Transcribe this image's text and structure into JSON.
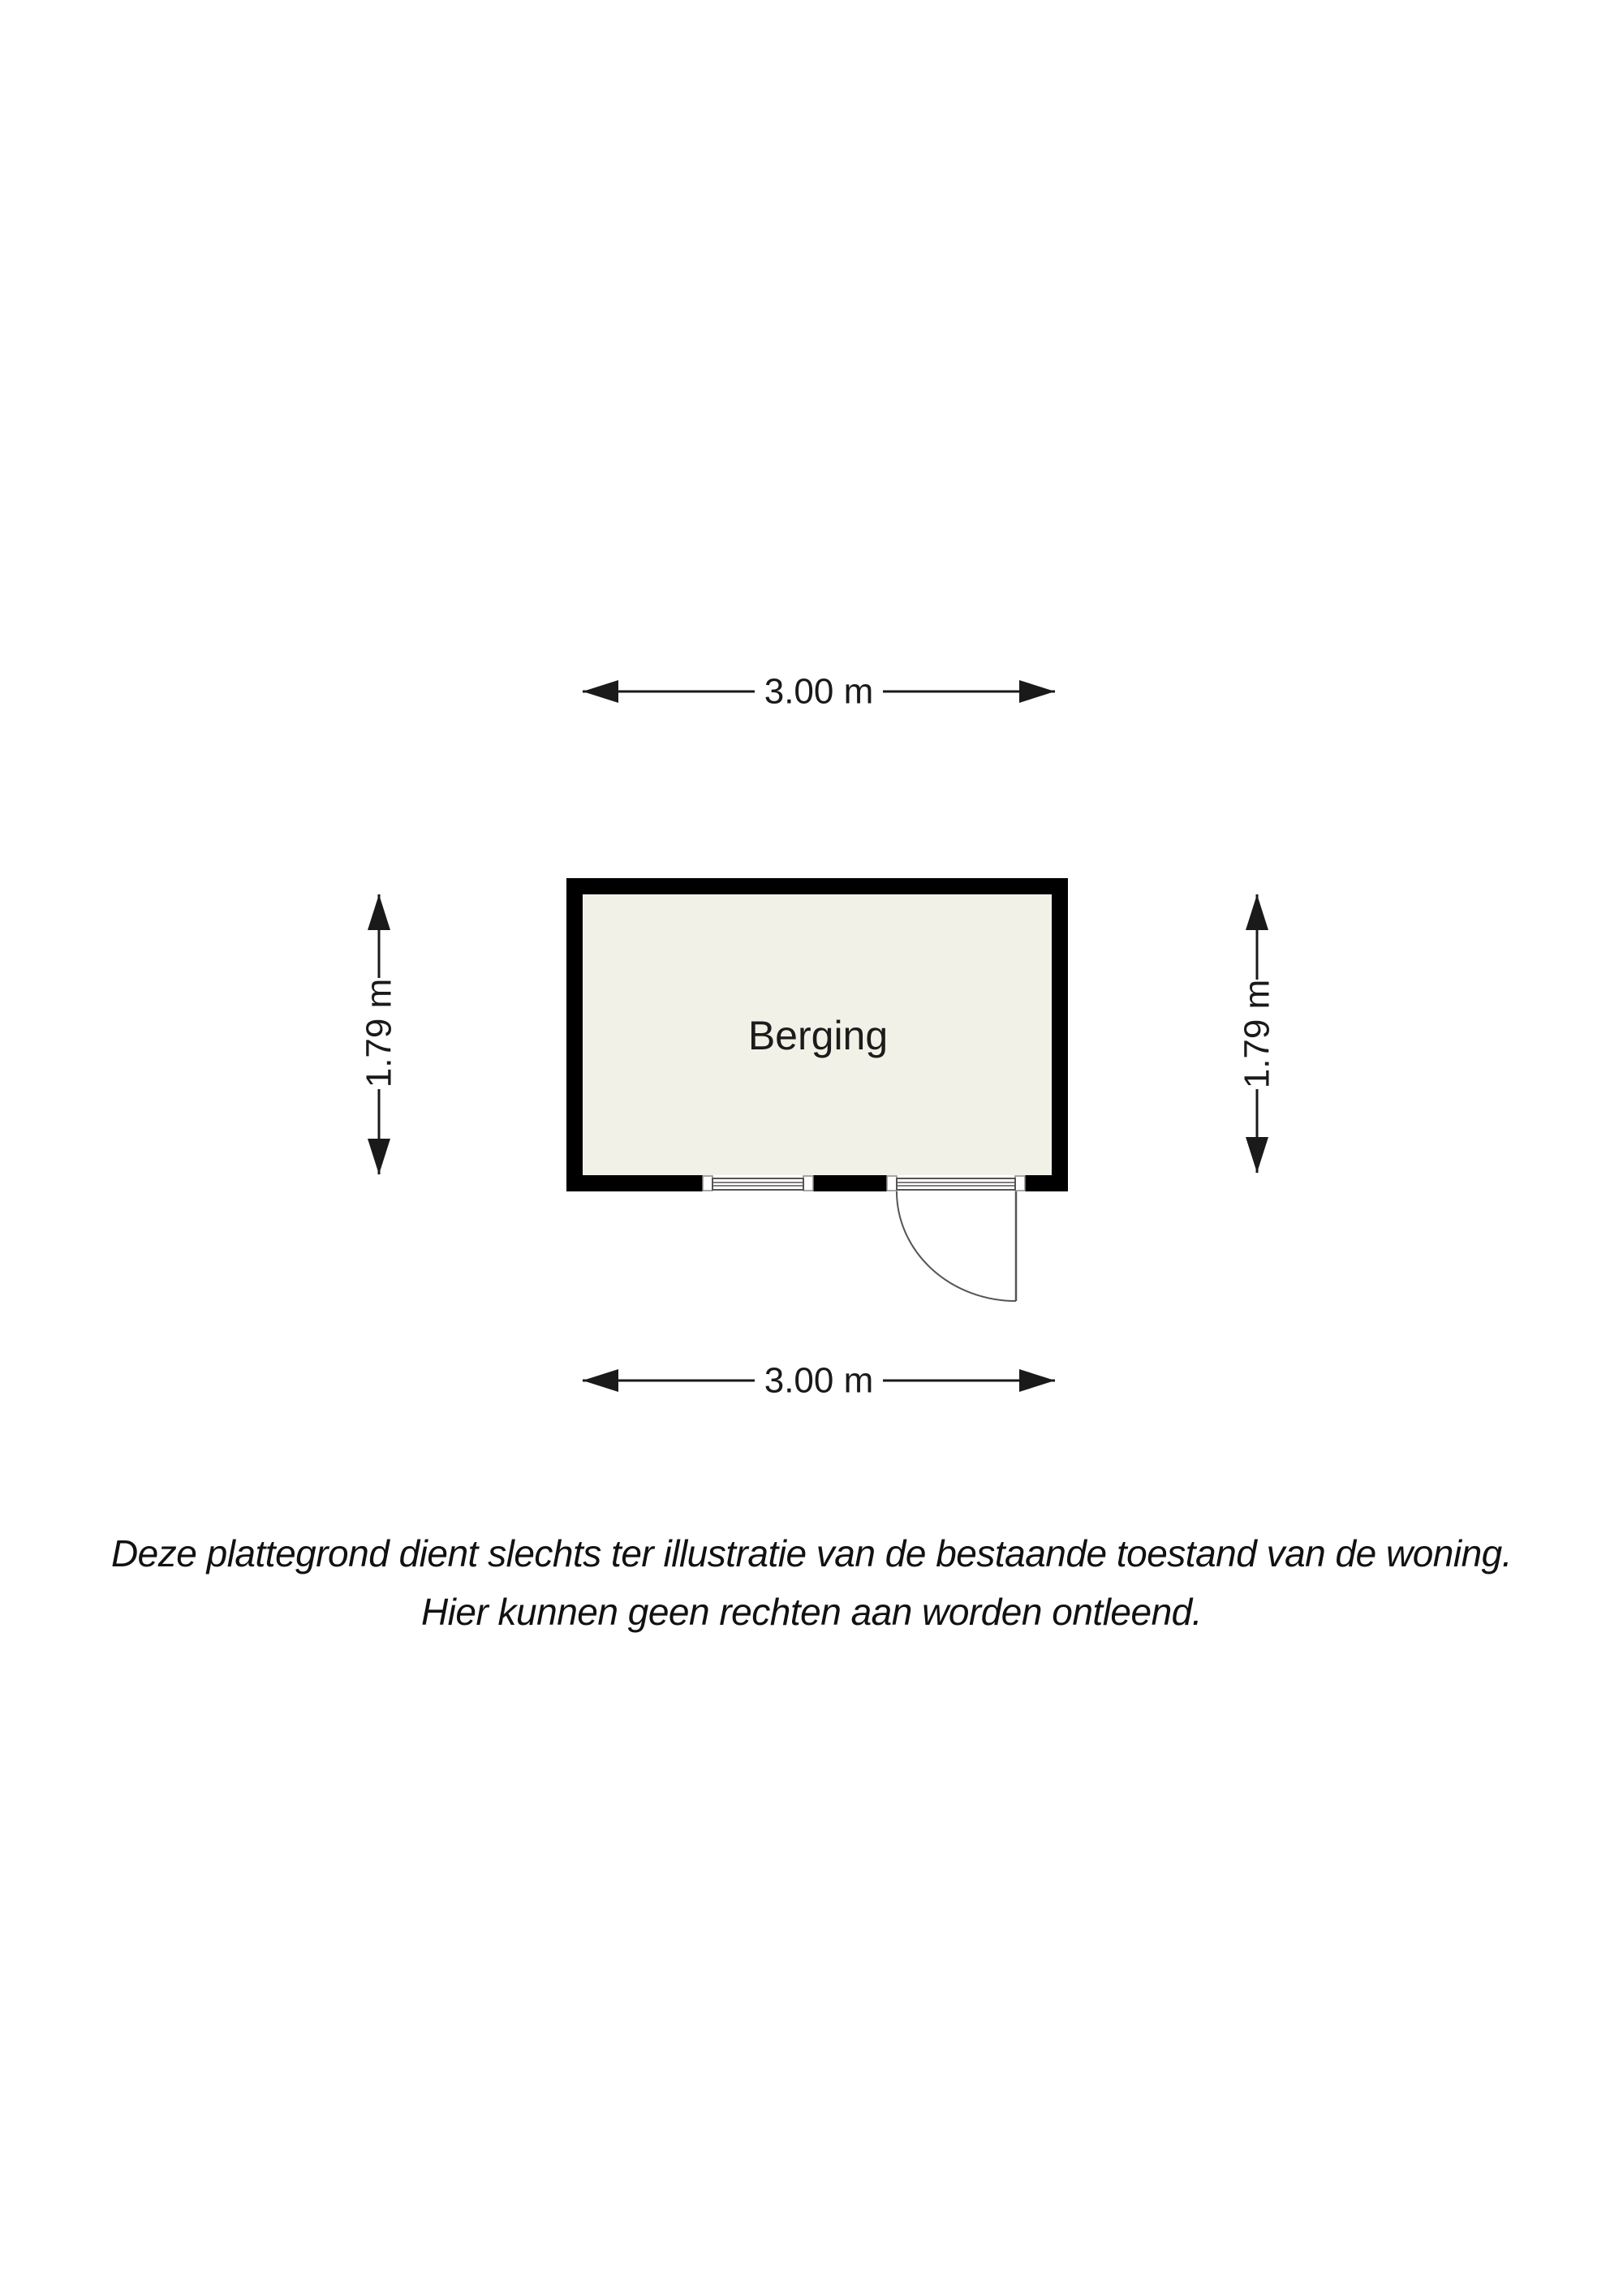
{
  "floorplan": {
    "room": {
      "name": "Berging",
      "floor_color": "#f2f1e8",
      "wall_color": "#000000"
    },
    "dimensions": {
      "top": "3.00 m",
      "bottom": "3.00 m",
      "left": "1.79 m",
      "right": "1.79 m"
    }
  },
  "disclaimer": {
    "line1": "Deze plattegrond dient slechts ter illustratie van de bestaande toestand van de woning.",
    "line2": "Hier kunnen geen rechten aan worden ontleend."
  },
  "colors": {
    "dimension_line": "#1a1a1a",
    "door_window_line": "#555555",
    "jamb_border": "#8a8a8a",
    "background": "#ffffff"
  }
}
